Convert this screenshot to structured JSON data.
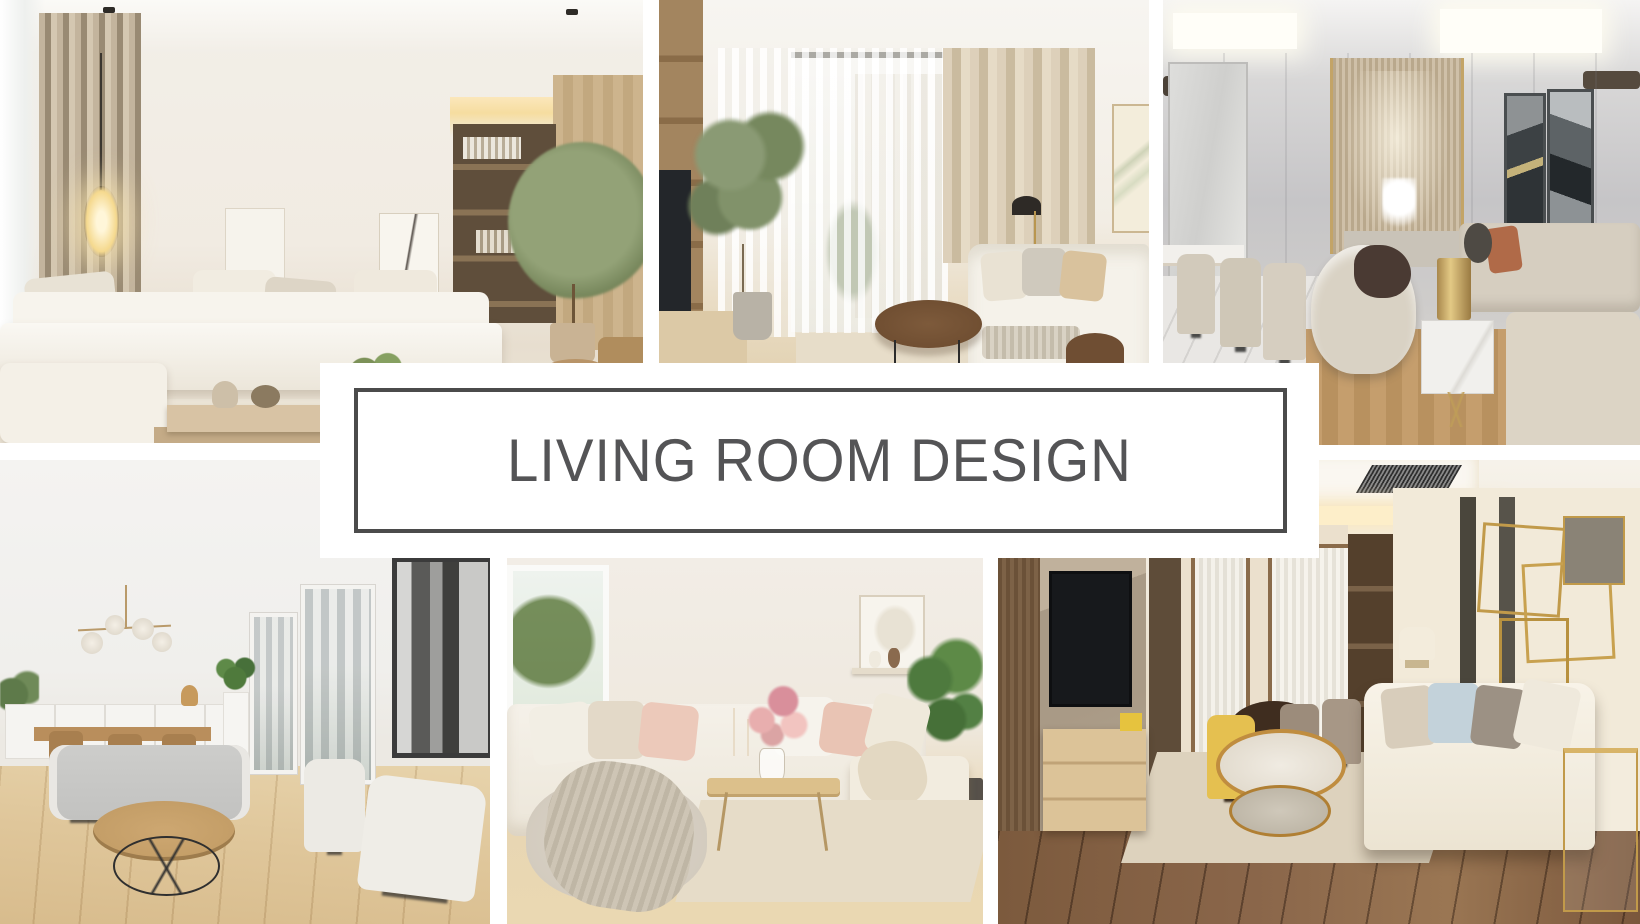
{
  "page": {
    "width_px": 1640,
    "height_px": 924,
    "background": "#ffffff"
  },
  "banner": {
    "title": "LIVING ROOM DESIGN",
    "text_color": "#545456",
    "border_color": "#4b4b4b",
    "background": "#ffffff"
  },
  "photos": [
    {
      "name": "photo-top-left",
      "description": "Bright neutral living room with cream L-shaped sectional sofa, taupe pleated curtains, glowing egg pendant lamp, leaning wall art, wooden coffee table with vases, built-in dark wood shelving niche with cove lighting and a potted indoor tree"
    },
    {
      "name": "photo-top-middle",
      "description": "Living room with wooden TV shelving unit, sheer white curtains over a bright window, beige drapes, potted ficus tree, black dome floor lamp, white sofa with neutral pillows and a round dark wood coffee table"
    },
    {
      "name": "photo-top-right",
      "description": "Luxury gray-beige lounge with upholstered dining chairs on marble floor, bronze slatted feature wall with white sculpture, two dark abstract art panels, modular beige sofas with rust pillow, brass drum lamp on a white marble side table with gold legs"
    },
    {
      "name": "photo-bottom-left",
      "description": "Scandinavian white living-dining room with brass globe chandelier, white sideboard, wooden dining table and chairs, gray bench sofa, two cream armchairs, round wood coffee table with black wire base, black-and-white city artwork and tall windows with skyline view"
    },
    {
      "name": "photo-bottom-middle",
      "description": "Cozy cream sectional sofa with blush and beige pillows, chunky knit throw over a pouf, light wood coffee table with pink flower bouquet and candles, wall shelf with small artwork, potted plant and wide-plank light wood floor"
    },
    {
      "name": "photo-bottom-right",
      "description": "Warm modern living room with marble TV wall and light wood media console, dining nook with yellow and taupe chairs, round brass-framed marble coffee table on a beige rug, cream sofa with pillows, gold geometric wall art and dark walnut plank floor"
    }
  ]
}
